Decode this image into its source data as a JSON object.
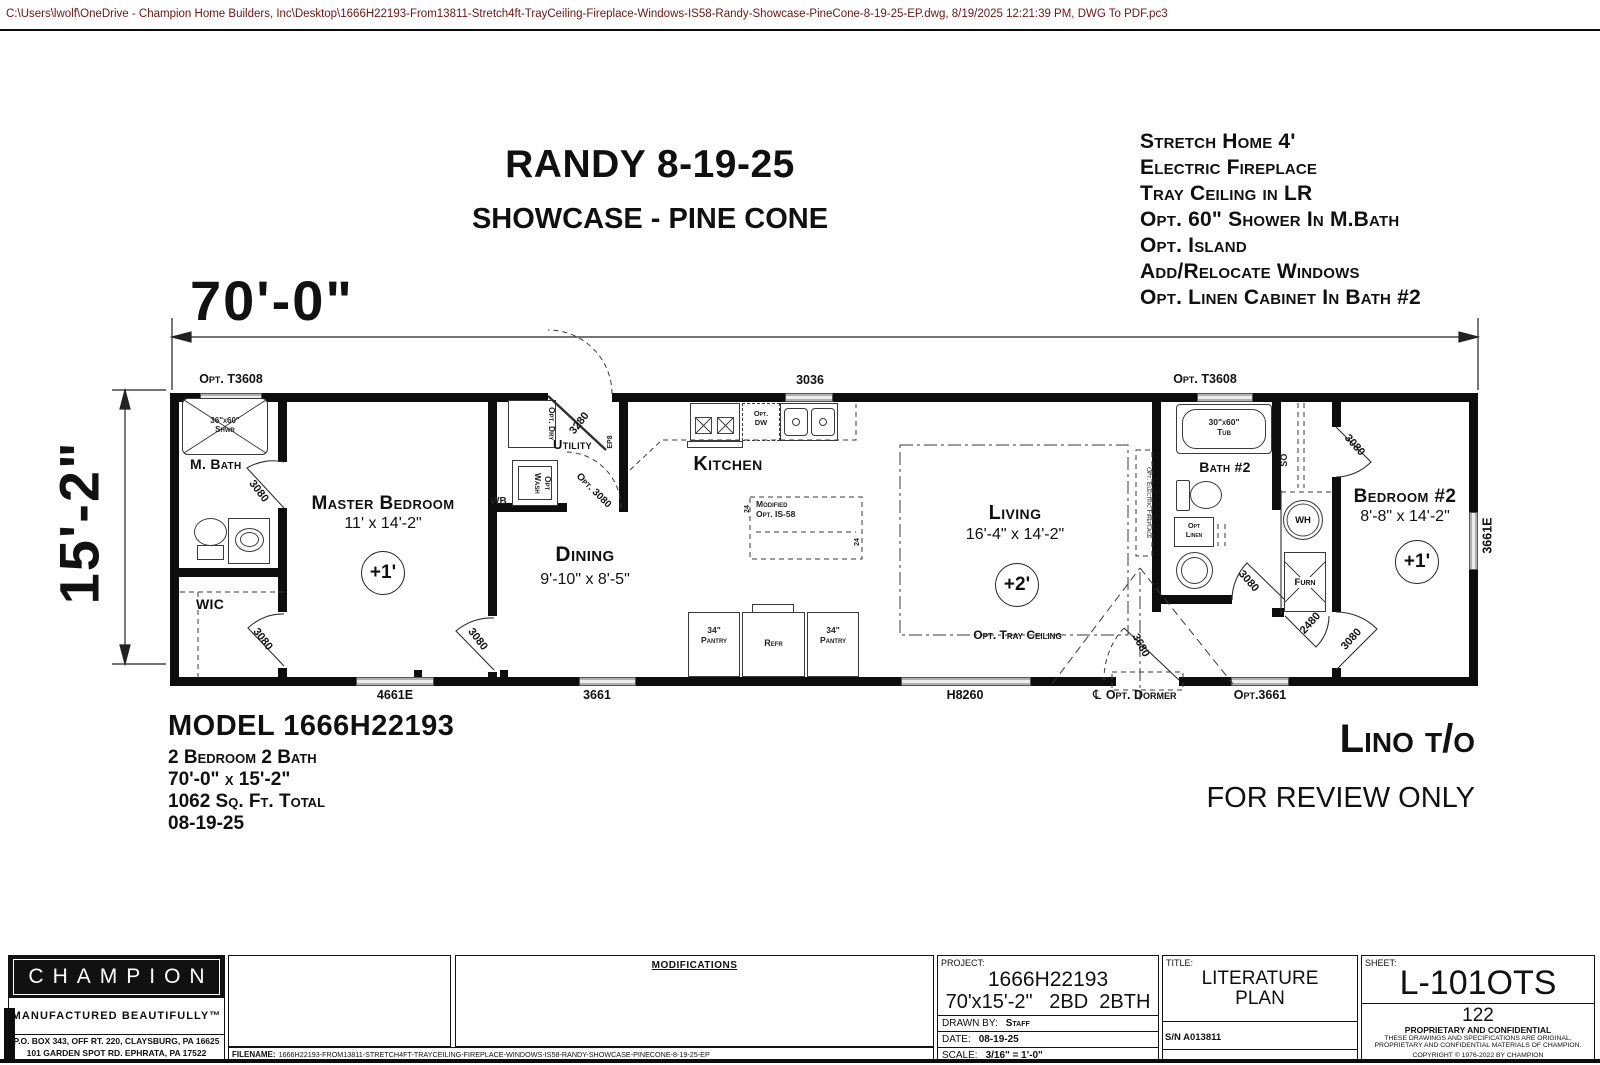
{
  "plot_stamp": "C:\\Users\\lwolf\\OneDrive - Champion Home Builders, Inc\\Desktop\\1666H22193-From13811-Stretch4ft-TrayCeiling-Fireplace-Windows-IS58-Randy-Showcase-PineCone-8-19-25-EP.dwg, 8/19/2025 12:21:39 PM, DWG To PDF.pc3",
  "title": {
    "line1": "RANDY 8-19-25",
    "line2": "SHOWCASE - PINE CONE"
  },
  "notes": [
    "Stretch Home 4'",
    "Electric Fireplace",
    "Tray Ceiling in LR",
    "Opt. 60\" Shower In M.Bath",
    "Opt. Island",
    "Add/Relocate Windows",
    "Opt. Linen Cabinet In Bath #2"
  ],
  "dims": {
    "width": "70'-0\"",
    "height": "15'-2\""
  },
  "rooms": {
    "master_bedroom": {
      "name": "Master Bedroom",
      "size": "11' x 14'-2\"",
      "floor": "+1'"
    },
    "m_bath": {
      "name": "M. Bath"
    },
    "wic": {
      "name": "WIC"
    },
    "dining": {
      "name": "Dining",
      "size": "9'-10\" x 8'-5\""
    },
    "utility": {
      "name": "Utility"
    },
    "kitchen": {
      "name": "Kitchen"
    },
    "living": {
      "name": "Living",
      "size": "16'-4\" x 14'-2\"",
      "floor": "+2'"
    },
    "bath2": {
      "name": "Bath #2"
    },
    "bedroom2": {
      "name": "Bedroom #2",
      "size": "8'-8\" x 14'-2\"",
      "floor": "+1'"
    }
  },
  "fixtures": {
    "shower_l1": "36\"x60\"",
    "shower_l2": "Shwr",
    "tub_l1": "30\"x60\"",
    "tub_l2": "Tub",
    "opt_dry": "Opt. Dry",
    "opt_wash": "Opt Wash",
    "wb": "WB",
    "ep": "EP8",
    "opt_dw_l1": "Opt.",
    "opt_dw_l2": "DW",
    "island_l1": "Modified",
    "island_l2": "Opt. IS-58",
    "island_depth": "24",
    "pantry_l1": "34\"",
    "pantry_l2": "Pantry",
    "refr": "Refr",
    "wh": "WH",
    "furn": "Furn",
    "opt_linen_l1": "Opt",
    "opt_linen_l2": "Linen",
    "so": "SO",
    "fireplace": "Opt. Electric Fireplace",
    "tray_ceiling": "Opt. Tray Ceiling",
    "dormer": "Opt. Dormer",
    "centerline": "℄"
  },
  "openings": {
    "t3608": "Opt. T3608",
    "w3036": "3036",
    "w4661e": "4661E",
    "w3661": "3661",
    "h8260": "H8260",
    "opt3661": "Opt.3661",
    "w3661e": "3661E",
    "d3080": "3080",
    "d3280": "3280",
    "opt3080": "Opt. 3080",
    "d2480": "2480",
    "d3680": "3680"
  },
  "model": {
    "line1": "MODEL 1666H22193",
    "line2": "2 Bedroom 2 Bath",
    "line3": "70'-0\" x 15'-2\"",
    "line4": "1062 Sq. Ft. Total",
    "line5": "08-19-25"
  },
  "stamp": {
    "lino": "Lino t/o",
    "review": "FOR REVIEW ONLY"
  },
  "titleblock": {
    "brand": "CHAMPION",
    "tagline": "MANUFACTURED BEAUTIFULLY™",
    "address1": "P.O. BOX 343, OFF RT. 220, CLAYSBURG, PA  16625",
    "address2": "101 GARDEN SPOT RD.  EPHRATA, PA  17522",
    "modifications": "MODIFICATIONS",
    "filename_label": "FILENAME:",
    "filename": "1666H22193-FROM13811-STRETCH4FT-TRAYCEILING-FIREPLACE-WINDOWS-IS58-RANDY-SHOWCASE-PINECONE-8-19-25-EP",
    "project_label": "PROJECT:",
    "project_number": "1666H22193",
    "project_desc": "70'x15'-2\"   2BD  2BTH",
    "drawn_by_label": "DRAWN BY:",
    "drawn_by": "Staff",
    "date_label": "DATE:",
    "date": "08-19-25",
    "scale_label": "SCALE:",
    "scale": "3/16\" = 1'-0\"",
    "sn": "S/N A013811",
    "title_label": "TITLE:",
    "title_line1": "LITERATURE",
    "title_line2": "PLAN",
    "sheet_label": "SHEET:",
    "sheet": "L-101OTS",
    "sheet_number": "122",
    "prop_title": "PROPRIETARY AND CONFIDENTIAL",
    "prop_line1": "THESE DRAWINGS AND SPECIFICATIONS ARE ORIGINAL,",
    "prop_line2": "PROPRIETARY AND CONFIDENTIAL MATERIALS OF CHAMPION.",
    "copyright": "COPYRIGHT © 1976-2022 BY CHAMPION"
  }
}
